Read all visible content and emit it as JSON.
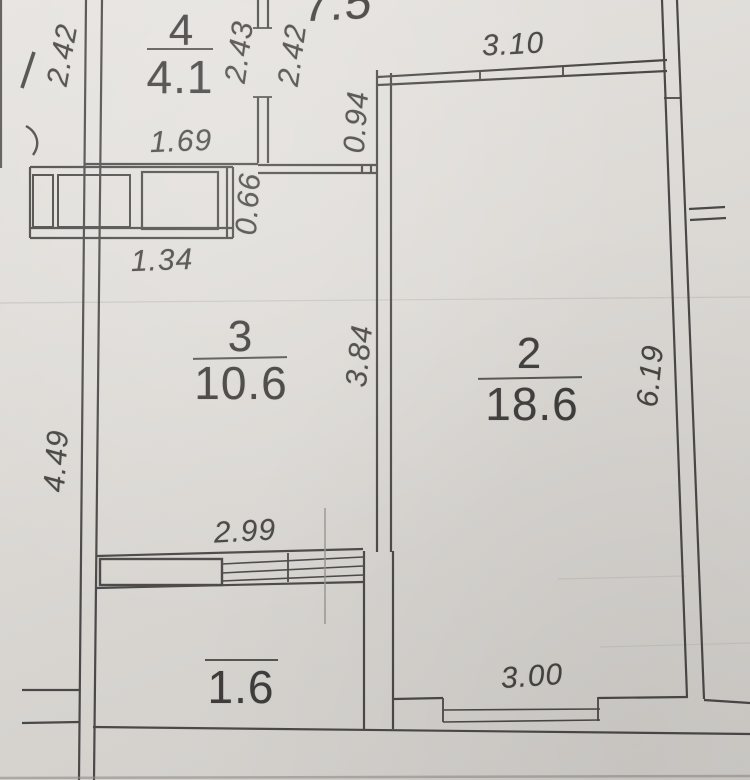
{
  "rooms": {
    "room1": {
      "area": "7.5"
    },
    "room2": {
      "number": "2",
      "area": "18.6"
    },
    "room3": {
      "number": "3",
      "area": "10.6"
    },
    "room4": {
      "number": "4",
      "area": "4.1"
    },
    "balcony": {
      "area": "1.6"
    }
  },
  "dimensions": {
    "left_top": "2.42",
    "room4_right": "2.43",
    "hall_right": "2.42",
    "room2_top": "3.10",
    "hall_width": "0.94",
    "room4_bottom": "1.69",
    "closet_depth": "0.66",
    "closet_width": "1.34",
    "room3_height": "3.84",
    "room2_height": "6.19",
    "left_wall_height": "4.49",
    "room3_width": "2.99",
    "room2_width": "3.00"
  },
  "colors": {
    "paper": "#dcd8d4",
    "wall_line": "#4a4947",
    "label_text": "#3e3d3b"
  }
}
